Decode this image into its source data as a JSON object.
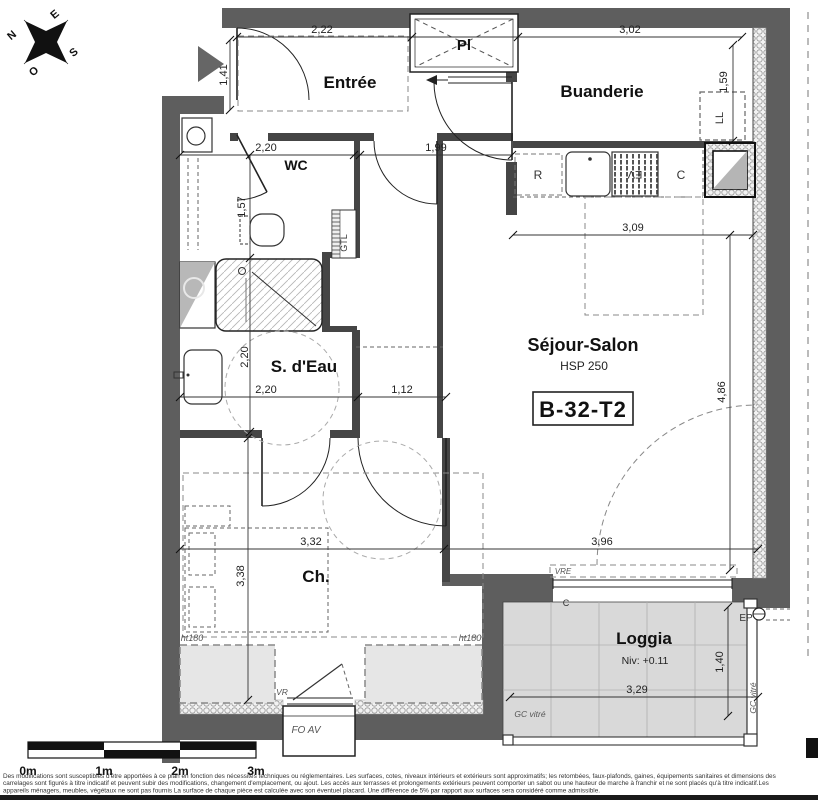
{
  "plan": {
    "unit_id": "B-32-T2",
    "room_labels": [
      {
        "label": "Entrée",
        "x": 350,
        "y": 88,
        "size": 17
      },
      {
        "label": "Pl",
        "x": 464,
        "y": 50,
        "size": 15
      },
      {
        "label": "Buanderie",
        "x": 602,
        "y": 97,
        "size": 17
      },
      {
        "label": "WC",
        "x": 296,
        "y": 170,
        "size": 14
      },
      {
        "label": "S. d'Eau",
        "x": 304,
        "y": 372,
        "size": 17
      },
      {
        "label": "Séjour-Salon",
        "x": 583,
        "y": 351,
        "size": 18
      },
      {
        "label": "Ch.",
        "x": 316,
        "y": 582,
        "size": 17
      },
      {
        "label": "Loggia",
        "x": 644,
        "y": 644,
        "size": 17
      }
    ],
    "sub_labels": [
      {
        "label": "HSP 250",
        "x": 584,
        "y": 370,
        "size": 12
      },
      {
        "label": "Niv: +0.11",
        "x": 645,
        "y": 664,
        "size": 10.5
      }
    ],
    "dim_labels": [
      {
        "label": "2,22",
        "x": 322,
        "y": 33
      },
      {
        "label": "3,02",
        "x": 630,
        "y": 33
      },
      {
        "label": "1,41",
        "x": 227,
        "y": 75,
        "rot": -90
      },
      {
        "label": "1,59",
        "x": 727,
        "y": 82,
        "rot": -90
      },
      {
        "label": "2,20",
        "x": 266,
        "y": 151
      },
      {
        "label": "1,99",
        "x": 436,
        "y": 151
      },
      {
        "label": "1,57",
        "x": 245,
        "y": 207,
        "rot": -90
      },
      {
        "label": "3,09",
        "x": 633,
        "y": 231
      },
      {
        "label": "4,86",
        "x": 725,
        "y": 392,
        "rot": -90
      },
      {
        "label": "2,20",
        "x": 248,
        "y": 357,
        "rot": -90
      },
      {
        "label": "2,20",
        "x": 266,
        "y": 393
      },
      {
        "label": "1,12",
        "x": 402,
        "y": 393
      },
      {
        "label": "3,32",
        "x": 311,
        "y": 545
      },
      {
        "label": "3,96",
        "x": 602,
        "y": 545
      },
      {
        "label": "3,38",
        "x": 244,
        "y": 576,
        "rot": -90
      },
      {
        "label": "3,29",
        "x": 637,
        "y": 693
      },
      {
        "label": "1,40",
        "x": 723,
        "y": 662,
        "rot": -90
      }
    ],
    "annotations": [
      {
        "label": "R",
        "x": 538,
        "y": 179,
        "size": 12
      },
      {
        "label": "EV",
        "x": 635,
        "y": 171,
        "size": 11,
        "rot": 180
      },
      {
        "label": "C",
        "x": 681,
        "y": 179,
        "size": 12
      },
      {
        "label": "LL",
        "x": 723,
        "y": 118,
        "size": 11,
        "rot": -90
      },
      {
        "label": "GTL",
        "x": 347,
        "y": 243,
        "size": 9,
        "rot": -90
      },
      {
        "label": "VRE",
        "x": 563,
        "y": 574,
        "size": 8,
        "italic": true
      },
      {
        "label": "C",
        "x": 566,
        "y": 606,
        "size": 9
      },
      {
        "label": "EP",
        "x": 746,
        "y": 621,
        "size": 10
      },
      {
        "label": "VR",
        "x": 282,
        "y": 695,
        "size": 8.5,
        "italic": true
      },
      {
        "label": "FO AV",
        "x": 306,
        "y": 733,
        "size": 10,
        "italic": true
      },
      {
        "label": "GC vitré",
        "x": 530,
        "y": 717,
        "size": 8.5,
        "italic": true
      },
      {
        "label": "GC vitré",
        "x": 756,
        "y": 698,
        "size": 8.5,
        "italic": true,
        "rot": -90
      },
      {
        "label": "ht180",
        "x": 192,
        "y": 641,
        "size": 9,
        "italic": true
      },
      {
        "label": "ht180",
        "x": 470,
        "y": 641,
        "size": 9,
        "italic": true
      }
    ],
    "compass": {
      "points": [
        {
          "label": "N",
          "x": 14,
          "y": 38,
          "rot": -40
        },
        {
          "label": "E",
          "x": 57,
          "y": 17,
          "rot": -40
        },
        {
          "label": "S",
          "x": 76,
          "y": 55,
          "rot": -40
        },
        {
          "label": "O",
          "x": 36,
          "y": 74,
          "rot": -40
        }
      ]
    },
    "scale_bar": {
      "labels": [
        {
          "label": "0m",
          "x": 28
        },
        {
          "label": "1m",
          "x": 104
        },
        {
          "label": "2m",
          "x": 180
        },
        {
          "label": "3m",
          "x": 256
        }
      ]
    },
    "disclaimer": [
      "Des modifications sont susceptibles d'être apportées à ce plan en fonction des nécessités techniques ou réglementaires. Les surfaces, cotes, niveaux intérieurs et extérieurs sont approximatifs; les retombées, faux-plafonds, gaines, équipements sanitaires et dimensions des",
      "carrelages sont figurés à titre indicatif et peuvent subir des modifications, changement d'emplacement, ou ajout. Les accès aux terrasses et prolongements extérieurs peuvent comporter un sabot ou une hauteur de marche à franchir et ne sont placés qu'à titre indicatif.Les",
      "appareils ménagers, meubles, végétaux ne sont pas fournis La surface de chaque pièce est calculée avec son éventuel placard. Une différence de 5% par rapport aux surfaces sera considéré comme admissible."
    ]
  }
}
